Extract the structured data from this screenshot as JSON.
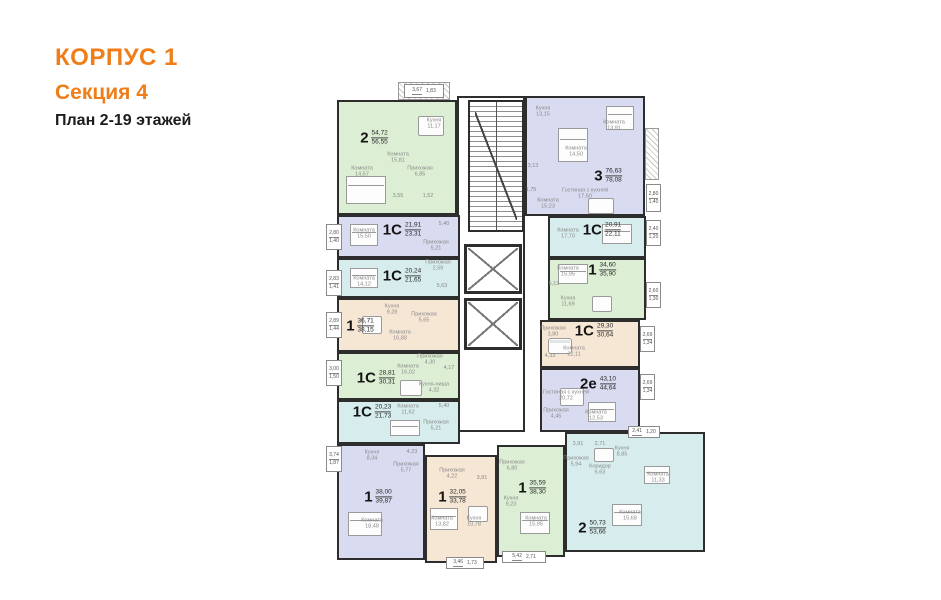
{
  "header": {
    "building": "КОРПУС 1",
    "section": "Секция 4",
    "plan": "План 2-19 этажей",
    "accent_color": "#EF7E19"
  },
  "palette": {
    "wall": "#2d2d2d",
    "apartment_fills": {
      "green": "#dcefd4",
      "lavender": "#d9dbf1",
      "cyan": "#d7eded",
      "beige": "#f6e6d4"
    }
  },
  "apartments": [
    {
      "type": "2",
      "area1": "54,72",
      "area2": "56,55",
      "color": "green",
      "bbox": [
        337,
        100,
        120,
        115
      ],
      "label": [
        374,
        138
      ],
      "rooms": [
        {
          "n": "Кухня",
          "a": "11,17",
          "x": 434,
          "y": 124
        },
        {
          "n": "Комната",
          "a": "15,81",
          "x": 398,
          "y": 158
        },
        {
          "n": "Комната",
          "a": "14,57",
          "x": 362,
          "y": 172
        },
        {
          "n": "Прихожая",
          "a": "6,85",
          "x": 420,
          "y": 172
        },
        {
          "n": "",
          "a": "3,55",
          "x": 398,
          "y": 196
        },
        {
          "n": "",
          "a": "1,52",
          "x": 428,
          "y": 196
        }
      ],
      "balconies": [
        {
          "x": 404,
          "y": 84,
          "w": 40,
          "h": 14,
          "v1": "3,67",
          "v2": "1,83",
          "horiz": true
        }
      ]
    },
    {
      "type": "1С",
      "area1": "21,91",
      "area2": "23,31",
      "color": "lavender",
      "bbox": [
        337,
        215,
        123,
        43
      ],
      "label": [
        402,
        230
      ],
      "rooms": [
        {
          "n": "Комната",
          "a": "15,50",
          "x": 364,
          "y": 234
        },
        {
          "n": "Прихожая",
          "a": "5,21",
          "x": 436,
          "y": 246
        },
        {
          "n": "",
          "a": "5,40",
          "x": 444,
          "y": 224
        }
      ],
      "balconies": [
        {
          "x": 326,
          "y": 224,
          "w": 16,
          "h": 26,
          "v1": "2,80",
          "v2": "1,40"
        }
      ]
    },
    {
      "type": "1С",
      "area1": "20,24",
      "area2": "21,65",
      "color": "cyan",
      "bbox": [
        337,
        258,
        123,
        40
      ],
      "label": [
        402,
        276
      ],
      "rooms": [
        {
          "n": "Комната",
          "a": "14,12",
          "x": 364,
          "y": 282
        },
        {
          "n": "Прихожая",
          "a": "2,59",
          "x": 438,
          "y": 266
        },
        {
          "n": "",
          "a": "5,63",
          "x": 442,
          "y": 286
        }
      ],
      "balconies": [
        {
          "x": 326,
          "y": 270,
          "w": 16,
          "h": 26,
          "v1": "2,83",
          "v2": "1,41"
        }
      ]
    },
    {
      "type": "1",
      "area1": "36,71",
      "area2": "38,15",
      "color": "beige",
      "bbox": [
        337,
        298,
        123,
        54
      ],
      "label": [
        360,
        326
      ],
      "rooms": [
        {
          "n": "Кухня",
          "a": "9,28",
          "x": 392,
          "y": 310
        },
        {
          "n": "Прихожая",
          "a": "5,65",
          "x": 424,
          "y": 318
        },
        {
          "n": "Комната",
          "a": "16,88",
          "x": 400,
          "y": 336
        }
      ],
      "balconies": [
        {
          "x": 326,
          "y": 312,
          "w": 16,
          "h": 26,
          "v1": "2,89",
          "v2": "1,44"
        }
      ]
    },
    {
      "type": "1С",
      "area1": "28,81",
      "area2": "30,31",
      "color": "green",
      "bbox": [
        337,
        352,
        123,
        48
      ],
      "label": [
        376,
        378
      ],
      "rooms": [
        {
          "n": "Прихожая",
          "a": "4,30",
          "x": 430,
          "y": 360
        },
        {
          "n": "",
          "a": "4,17",
          "x": 449,
          "y": 368
        },
        {
          "n": "Комната",
          "a": "16,02",
          "x": 408,
          "y": 370
        },
        {
          "n": "Кухня-ниша",
          "a": "4,32",
          "x": 434,
          "y": 388
        }
      ],
      "balconies": [
        {
          "x": 326,
          "y": 360,
          "w": 16,
          "h": 26,
          "v1": "3,00",
          "v2": "1,50"
        }
      ]
    },
    {
      "type": "1С",
      "area1": "20,23",
      "area2": "21,73",
      "color": "cyan",
      "bbox": [
        337,
        400,
        123,
        44
      ],
      "label": [
        372,
        412
      ],
      "rooms": [
        {
          "n": "Комната",
          "a": "11,62",
          "x": 408,
          "y": 410
        },
        {
          "n": "",
          "a": "5,40",
          "x": 444,
          "y": 406
        },
        {
          "n": "Прихожая",
          "a": "5,21",
          "x": 436,
          "y": 426
        }
      ],
      "balconies": []
    },
    {
      "type": "1",
      "area1": "38,00",
      "area2": "39,87",
      "color": "lavender",
      "bbox": [
        337,
        444,
        88,
        116
      ],
      "label": [
        378,
        497
      ],
      "rooms": [
        {
          "n": "Кухня",
          "a": "8,34",
          "x": 372,
          "y": 456
        },
        {
          "n": "Прихожая",
          "a": "5,77",
          "x": 406,
          "y": 468
        },
        {
          "n": "",
          "a": "4,23",
          "x": 412,
          "y": 452
        },
        {
          "n": "Комната",
          "a": "18,48",
          "x": 372,
          "y": 524
        }
      ],
      "balconies": [
        {
          "x": 326,
          "y": 446,
          "w": 16,
          "h": 26,
          "v1": "3,74",
          "v2": "1,87"
        }
      ]
    },
    {
      "type": "1",
      "area1": "32,05",
      "area2": "33,78",
      "color": "beige",
      "bbox": [
        425,
        455,
        72,
        108
      ],
      "label": [
        452,
        497
      ],
      "rooms": [
        {
          "n": "Прихожая",
          "a": "4,22",
          "x": 452,
          "y": 474
        },
        {
          "n": "",
          "a": "3,81",
          "x": 482,
          "y": 478
        },
        {
          "n": "Комната",
          "a": "13,82",
          "x": 442,
          "y": 522
        },
        {
          "n": "Кухня",
          "a": "10,78",
          "x": 474,
          "y": 522
        }
      ],
      "balconies": [
        {
          "x": 446,
          "y": 557,
          "w": 38,
          "h": 12,
          "v1": "3,46",
          "v2": "1,73",
          "horiz": true
        }
      ]
    },
    {
      "type": "1",
      "area1": "35,59",
      "area2": "38,30",
      "color": "green",
      "bbox": [
        497,
        445,
        68,
        112
      ],
      "label": [
        532,
        488
      ],
      "rooms": [
        {
          "n": "Прихожая",
          "a": "6,80",
          "x": 512,
          "y": 466
        },
        {
          "n": "Кухня",
          "a": "9,23",
          "x": 511,
          "y": 502
        },
        {
          "n": "Комната",
          "a": "15,95",
          "x": 536,
          "y": 522
        }
      ],
      "balconies": [
        {
          "x": 502,
          "y": 551,
          "w": 44,
          "h": 12,
          "v1": "5,42",
          "v2": "2,71",
          "horiz": true
        }
      ]
    },
    {
      "type": "3",
      "area1": "76,63",
      "area2": "78,08",
      "color": "lavender",
      "bbox": [
        525,
        96,
        120,
        120
      ],
      "label": [
        608,
        176
      ],
      "rooms": [
        {
          "n": "Кухня",
          "a": "13,15",
          "x": 543,
          "y": 112
        },
        {
          "n": "Комната",
          "a": "13,91",
          "x": 614,
          "y": 126
        },
        {
          "n": "Комната",
          "a": "14,50",
          "x": 576,
          "y": 152
        },
        {
          "n": "",
          "a": "3,13",
          "x": 533,
          "y": 166
        },
        {
          "n": "",
          "a": "1,75",
          "x": 531,
          "y": 190
        },
        {
          "n": "Гостиная с кухней",
          "a": "17,60",
          "x": 585,
          "y": 194
        },
        {
          "n": "Комната",
          "a": "15,23",
          "x": 548,
          "y": 204
        }
      ],
      "balconies": [
        {
          "x": 646,
          "y": 184,
          "w": 15,
          "h": 28,
          "v1": "2,80",
          "v2": "1,40"
        }
      ]
    },
    {
      "type": "1С",
      "area1": "20,91",
      "area2": "22,11",
      "color": "cyan",
      "bbox": [
        548,
        216,
        98,
        42
      ],
      "label": [
        602,
        230
      ],
      "rooms": [
        {
          "n": "Комната",
          "a": "17,70",
          "x": 568,
          "y": 234
        }
      ],
      "balconies": [
        {
          "x": 646,
          "y": 220,
          "w": 15,
          "h": 26,
          "v1": "2,40",
          "v2": "1,20"
        }
      ]
    },
    {
      "type": "1",
      "area1": "34,60",
      "area2": "35,90",
      "color": "green",
      "bbox": [
        548,
        258,
        98,
        62
      ],
      "label": [
        602,
        270
      ],
      "rooms": [
        {
          "n": "Комната",
          "a": "15,95",
          "x": 568,
          "y": 272
        },
        {
          "n": "",
          "a": "5,13",
          "x": 554,
          "y": 284
        },
        {
          "n": "Кухня",
          "a": "11,69",
          "x": 568,
          "y": 302
        }
      ],
      "balconies": [
        {
          "x": 646,
          "y": 282,
          "w": 15,
          "h": 26,
          "v1": "2,60",
          "v2": "1,30"
        }
      ]
    },
    {
      "type": "1С",
      "area1": "29,30",
      "area2": "30,64",
      "color": "beige",
      "bbox": [
        540,
        320,
        100,
        48
      ],
      "label": [
        594,
        331
      ],
      "rooms": [
        {
          "n": "Прихожая",
          "a": "3,80",
          "x": 553,
          "y": 332
        },
        {
          "n": "",
          "a": "4,33",
          "x": 550,
          "y": 356
        },
        {
          "n": "Комната",
          "a": "22,11",
          "x": 574,
          "y": 352
        }
      ],
      "balconies": [
        {
          "x": 640,
          "y": 326,
          "w": 15,
          "h": 26,
          "v1": "2,69",
          "v2": "1,34"
        }
      ]
    },
    {
      "type": "2е",
      "area1": "43,10",
      "area2": "44,64",
      "color": "lavender",
      "bbox": [
        540,
        368,
        100,
        64
      ],
      "label": [
        598,
        384
      ],
      "rooms": [
        {
          "n": "Гостиная с кухней",
          "a": "20,72",
          "x": 566,
          "y": 396
        },
        {
          "n": "Прихожая",
          "a": "4,45",
          "x": 556,
          "y": 414
        },
        {
          "n": "Комната",
          "a": "12,53",
          "x": 596,
          "y": 416
        }
      ],
      "balconies": [
        {
          "x": 640,
          "y": 374,
          "w": 15,
          "h": 26,
          "v1": "2,69",
          "v2": "1,34"
        }
      ]
    },
    {
      "type": "2",
      "area1": "50,73",
      "area2": "53,66",
      "color": "cyan",
      "bbox": [
        565,
        432,
        140,
        120
      ],
      "label": [
        592,
        528
      ],
      "rooms": [
        {
          "n": "",
          "a": "3,91",
          "x": 578,
          "y": 444
        },
        {
          "n": "",
          "a": "2,71",
          "x": 600,
          "y": 444
        },
        {
          "n": "Прихожая",
          "a": "5,94",
          "x": 576,
          "y": 462
        },
        {
          "n": "Коридор",
          "a": "6,63",
          "x": 600,
          "y": 470
        },
        {
          "n": "Кухня",
          "a": "8,85",
          "x": 622,
          "y": 452
        },
        {
          "n": "Комната",
          "a": "11,33",
          "x": 658,
          "y": 478
        },
        {
          "n": "Комната",
          "a": "15,68",
          "x": 630,
          "y": 516
        }
      ],
      "balconies": [
        {
          "x": 628,
          "y": 426,
          "w": 32,
          "h": 12,
          "v1": "2,41",
          "v2": "1,20",
          "horiz": true
        }
      ]
    }
  ],
  "furniture": [
    {
      "t": "bed",
      "b": [
        346,
        176,
        40,
        28
      ]
    },
    {
      "t": "table",
      "b": [
        418,
        116,
        26,
        20
      ]
    },
    {
      "t": "bed",
      "b": [
        350,
        224,
        28,
        22
      ]
    },
    {
      "t": "bed",
      "b": [
        350,
        268,
        28,
        20
      ]
    },
    {
      "t": "table",
      "b": [
        362,
        316,
        20,
        18
      ]
    },
    {
      "t": "table",
      "b": [
        400,
        380,
        22,
        16
      ]
    },
    {
      "t": "bed",
      "b": [
        390,
        420,
        30,
        16
      ]
    },
    {
      "t": "bed",
      "b": [
        348,
        512,
        34,
        24
      ]
    },
    {
      "t": "bed",
      "b": [
        430,
        508,
        28,
        22
      ]
    },
    {
      "t": "table",
      "b": [
        468,
        506,
        20,
        16
      ]
    },
    {
      "t": "bed",
      "b": [
        520,
        512,
        30,
        22
      ]
    },
    {
      "t": "bed",
      "b": [
        558,
        128,
        30,
        34
      ]
    },
    {
      "t": "bed",
      "b": [
        606,
        106,
        28,
        24
      ]
    },
    {
      "t": "table",
      "b": [
        588,
        198,
        26,
        16
      ]
    },
    {
      "t": "bed",
      "b": [
        602,
        224,
        30,
        20
      ]
    },
    {
      "t": "bed",
      "b": [
        558,
        264,
        30,
        20
      ]
    },
    {
      "t": "table",
      "b": [
        592,
        296,
        20,
        16
      ]
    },
    {
      "t": "sofa",
      "b": [
        548,
        338,
        24,
        16
      ]
    },
    {
      "t": "table",
      "b": [
        560,
        388,
        24,
        18
      ]
    },
    {
      "t": "bed",
      "b": [
        588,
        402,
        28,
        20
      ]
    },
    {
      "t": "table",
      "b": [
        594,
        448,
        20,
        14
      ]
    },
    {
      "t": "bed",
      "b": [
        644,
        466,
        26,
        18
      ]
    },
    {
      "t": "bed",
      "b": [
        612,
        504,
        30,
        22
      ]
    }
  ]
}
